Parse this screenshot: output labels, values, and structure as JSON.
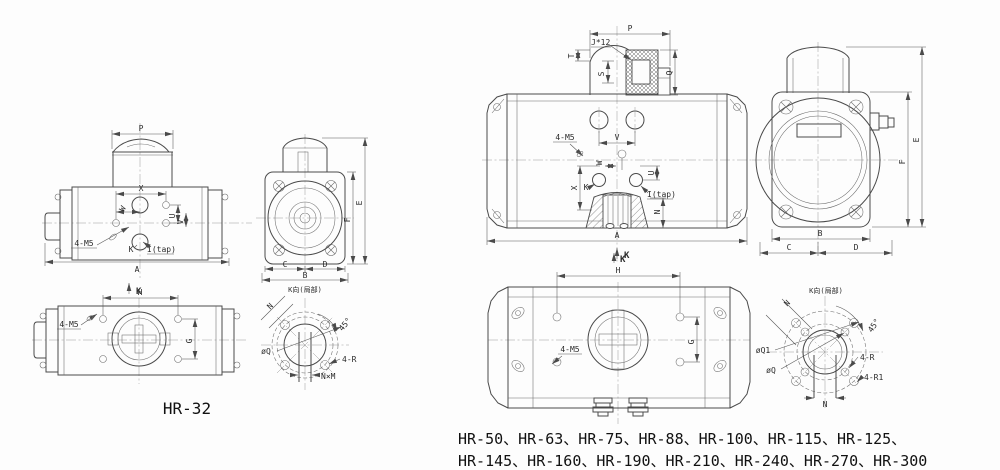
{
  "captions": {
    "left_model": "HR-32",
    "right_models_line1": "HR-50、HR-63、HR-75、HR-88、HR-100、HR-115、HR-125、",
    "right_models_line2": "HR-145、HR-160、HR-190、HR-210、HR-240、HR-270、HR-300"
  },
  "labels": {
    "p": "P",
    "x": "X",
    "w": "W",
    "u": "U",
    "v": "V",
    "k": "K",
    "itap": "I(tap)",
    "m5": "4-M5",
    "a": "A",
    "b": "B",
    "c": "C",
    "d": "D",
    "e": "E",
    "f": "F",
    "g": "G",
    "h": "H",
    "n": "N",
    "q": "Q",
    "t": "T",
    "s": "S",
    "j12": "J*12",
    "deg45": "45°",
    "phi_q": "øQ",
    "phi_q1": "øQ1",
    "r4": "4-R",
    "r1_4": "4-R1",
    "nxm": "N×M",
    "k_view": "K",
    "detail_title": "K向(局部)"
  }
}
